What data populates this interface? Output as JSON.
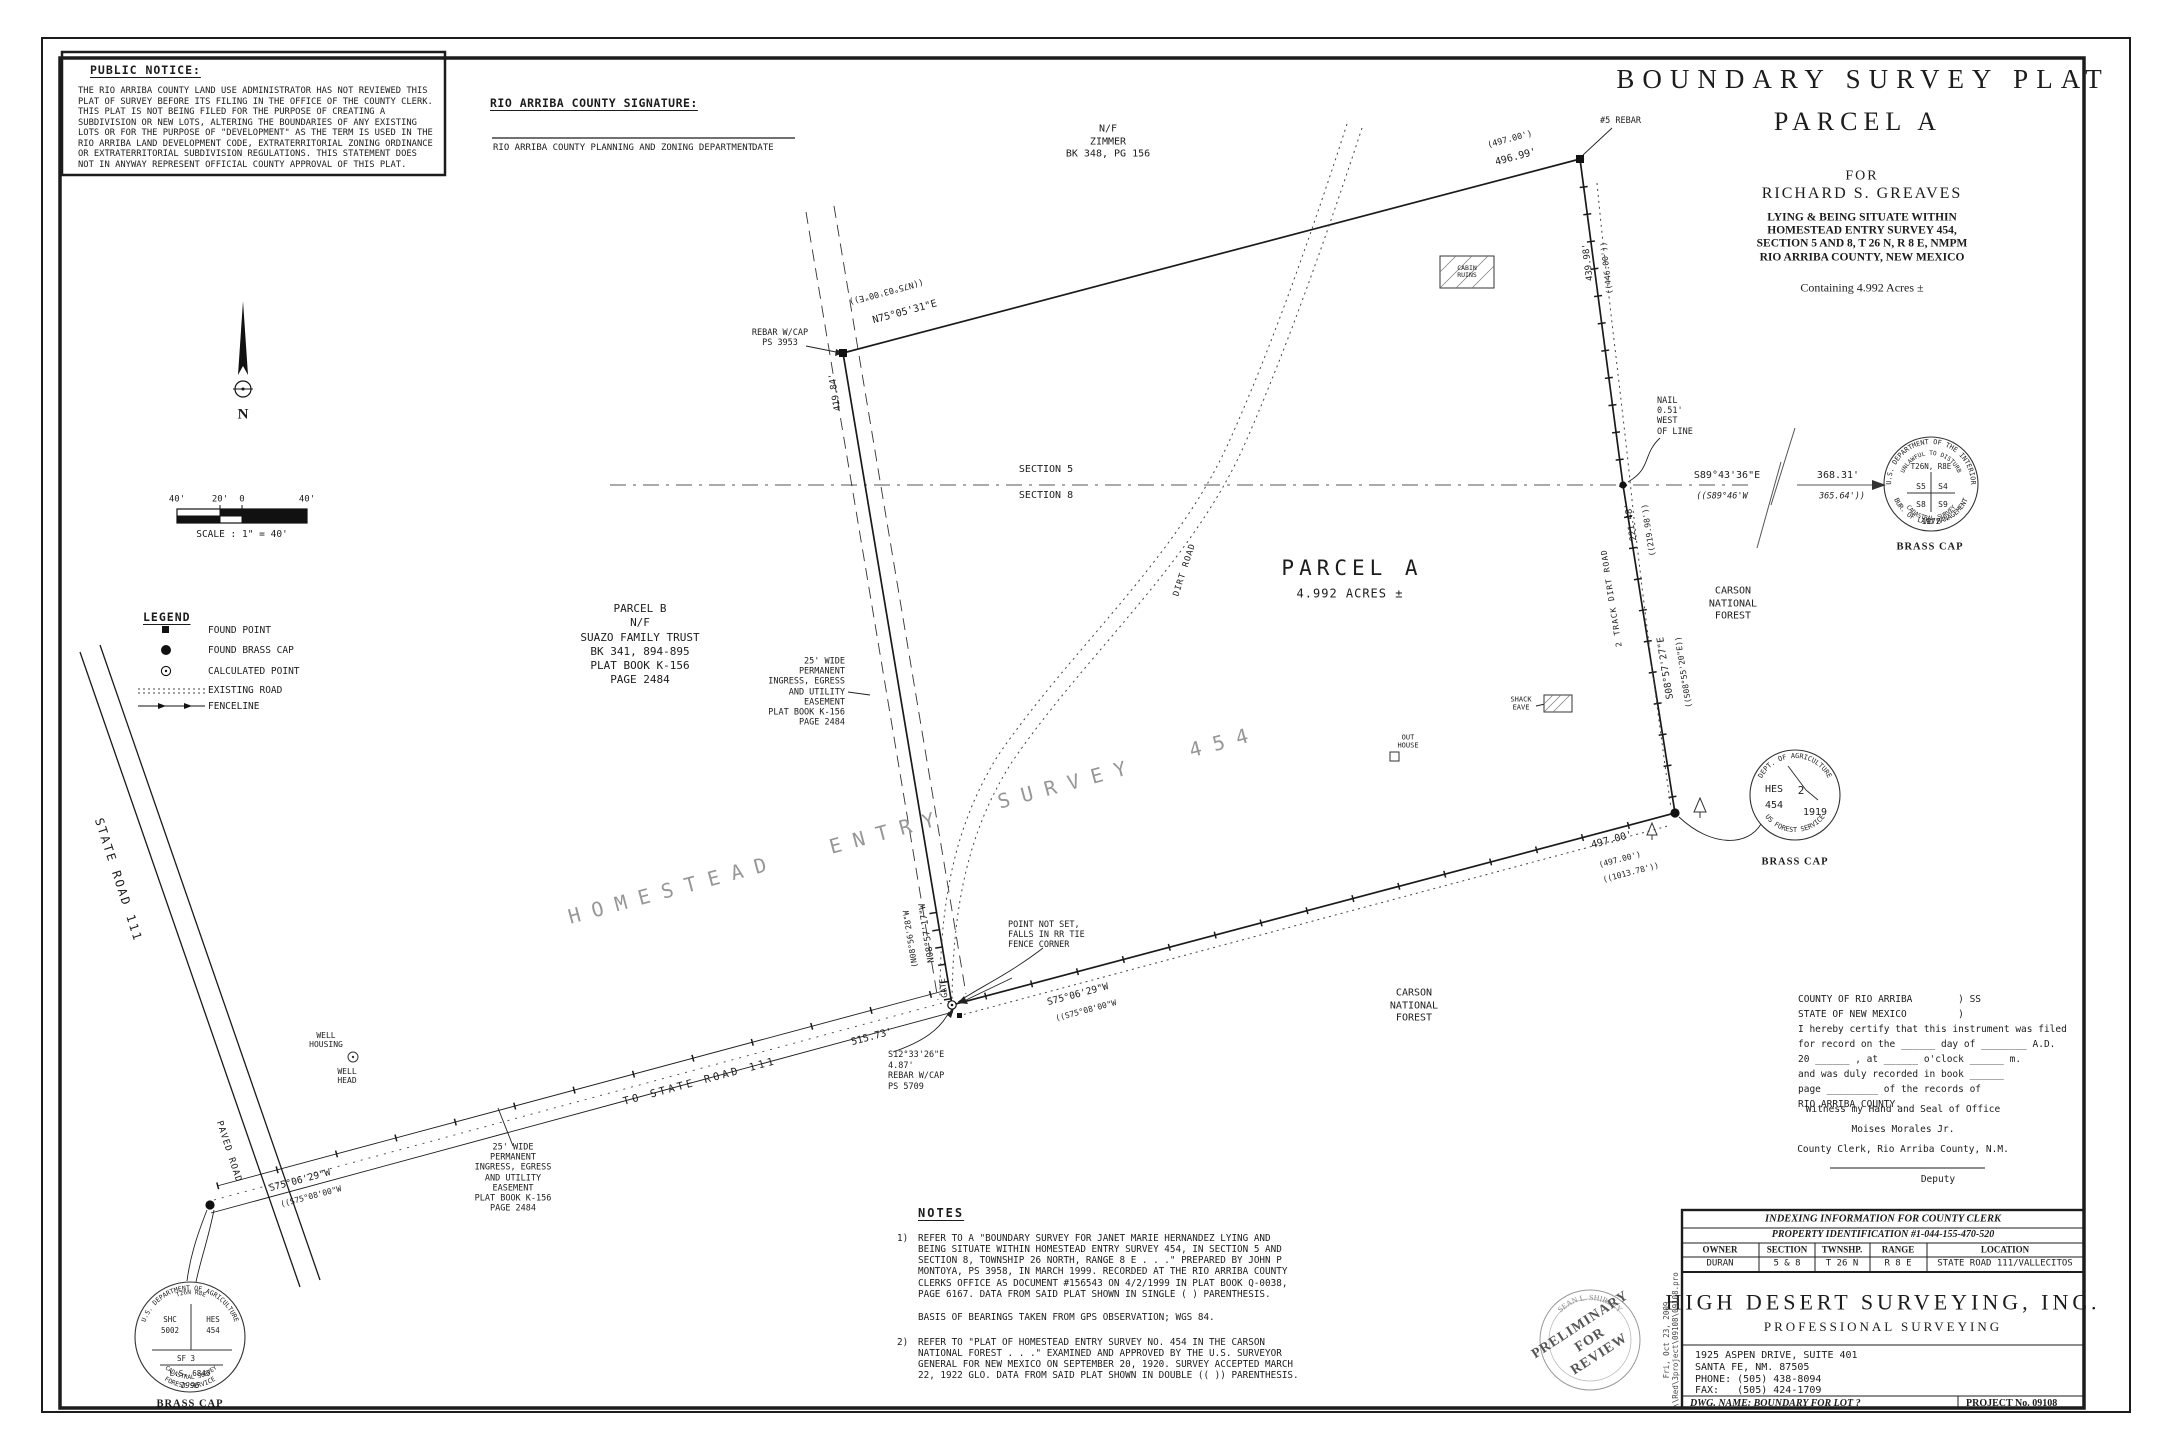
{
  "notice": {
    "heading": "PUBLIC NOTICE:",
    "body": "THE RIO ARRIBA COUNTY LAND USE ADMINISTRATOR HAS NOT REVIEWED THIS PLAT OF SURVEY BEFORE ITS FILING IN THE OFFICE OF THE COUNTY CLERK.  THIS PLAT IS NOT BEING FILED FOR THE PURPOSE OF CREATING A SUBDIVISION OR NEW LOTS, ALTERING THE BOUNDARIES OF ANY EXISTING LOTS OR FOR THE PURPOSE OF \"DEVELOPMENT\" AS THE TERM IS USED IN THE RIO ARRIBA LAND DEVELOPMENT CODE, EXTRATERRITORIAL ZONING ORDINANCE OR EXTRATERRITORIAL SUBDIVISION REGULATIONS.  THIS STATEMENT DOES NOT IN ANYWAY REPRESENT OFFICIAL COUNTY APPROVAL OF THIS PLAT."
  },
  "signature": {
    "heading": "RIO ARRIBA COUNTY SIGNATURE:",
    "dept": "RIO ARRIBA COUNTY PLANNING AND ZONING DEPARTMENT",
    "date": "DATE"
  },
  "title": {
    "main": "BOUNDARY SURVEY PLAT",
    "parcel": "PARCEL A",
    "for_label": "FOR",
    "client": "RICHARD S. GREAVES",
    "situate": "LYING & BEING SITUATE WITHIN\nHOMESTEAD ENTRY SURVEY 454,\nSECTION 5 AND 8, T 26 N, R 8 E, NMPM\nRIO ARRIBA COUNTY, NEW MEXICO",
    "containing": "Containing 4.992 Acres ±"
  },
  "compass": {
    "n": "N"
  },
  "scalebar": {
    "t1": "40'",
    "t2": "20'",
    "t3": "0",
    "t4": "40'",
    "label": "SCALE : 1\" = 40'"
  },
  "legend": {
    "heading": "LEGEND",
    "found_point": "FOUND POINT",
    "found_brass": "FOUND BRASS CAP",
    "calc_point": "CALCULATED POINT",
    "existing_road": "EXISTING ROAD",
    "fenceline": "FENCELINE"
  },
  "parcel_a": {
    "name": "PARCEL A",
    "area": "4.992 ACRES ±"
  },
  "parcel_b": {
    "text": "PARCEL B\nN/F\nSUAZO FAMILY TRUST\nBK 341, 894-895\nPLAT BOOK K-156\nPAGE 2484"
  },
  "zimmer": {
    "text": "N/F\nZIMMER\nBK 348, PG 156"
  },
  "easement_mid": {
    "text": "25' WIDE\nPERMANENT\nINGRESS, EGRESS\nAND UTILITY\nEASEMENT\nPLAT BOOK K-156\nPAGE 2484"
  },
  "easement_sw": {
    "text": "25' WIDE\nPERMANENT\nINGRESS, EGRESS\nAND UTILITY\nEASEMENT\nPLAT BOOK K-156\nPAGE 2484"
  },
  "hes_banner": "HOMESTEAD ENTRY SURVEY 454",
  "sections": {
    "s5": "SECTION 5",
    "s8": "SECTION 8"
  },
  "forest_e": "CARSON\nNATIONAL\nFOREST",
  "forest_s": "CARSON\nNATIONAL\nFOREST",
  "features": {
    "dirt_road": "DIRT ROAD",
    "two_track": "2 TRACK DIRT ROAD",
    "cabin": "CABIN\nRUINS",
    "shack": "SHACK\nEAVE",
    "outhouse": "OUT\nHOUSE",
    "gate": "GATE",
    "well": "WELL\nHOUSING",
    "well_head": "WELL\nHEAD",
    "paved_road": "PAVED ROAD",
    "state_road": "STATE ROAD 111",
    "to_state_road": "TO STATE ROAD 111"
  },
  "monuments": {
    "rebar_nw": "REBAR W/CAP\nPS 3953",
    "rebar_ne": "#5 REBAR",
    "nail": "NAIL\n0.51'\nWEST\nOF LINE",
    "point_not_set": "POINT NOT SET,\nFALLS IN RR TIE\nFENCE CORNER",
    "rebar_s": "S12°33'26\"E\n4.87'\nREBAR W/CAP\nPS 5709"
  },
  "bearings": {
    "top": "N75°05'31\"E",
    "top_paren": "((N75°03'00\"E))",
    "top_len": "496.99'",
    "top_len_paren": "(497.00')",
    "ne_len": "439.98'",
    "ne_len_paren": "((446.00'))",
    "sec": "S89°43'36\"E",
    "sec_paren": "((S89°46'W",
    "sec_len": "368.31'",
    "sec_len_paren": "365.64'))",
    "e_len": "221.48'",
    "e_len_paren": "((219.98'))",
    "e_brg": "S08°57'27\"E",
    "e_brg_paren": "((S08°55'20\"E))",
    "s_len": "497.00'",
    "s_len_p1": "(497.00')",
    "s_len_p2": "((1013.78'))",
    "s_brg": "S75°06'29\"W",
    "s_brg_paren": "((S75°08'00\"W",
    "w_brg": "N08°57'17\"W",
    "w_brg_paren": "(N08°56'28\"W",
    "w_len": "419.84'",
    "sw_brg": "S75°06'29\"W",
    "sw_brg_paren": "((S75°08'00\"W",
    "road_len": "515.73'"
  },
  "seal_blm": {
    "ring_top": "U.S. DEPARTMENT OF THE INTERIOR",
    "arc_top": "UNLAWFUL TO DISTURB",
    "twn": "T26N, R8E",
    "q1": "S5",
    "q2": "S4",
    "q3": "S8",
    "q4": "S9",
    "year": "1972",
    "arc_bottom": "CADASTRAL SURVEY",
    "ring_bottom": "BUR. OF LAND MANAGEMENT",
    "label": "BRASS CAP"
  },
  "seal_hes": {
    "ring_top": "DEPT. OF AGRICULTURE",
    "hes": "HES",
    "num": "454",
    "two": "2",
    "year": "1919",
    "ring_bottom": "US FOREST SERVICE",
    "label": "BRASS CAP"
  },
  "seal_fs": {
    "ring_top": "U.S. DEPARTMENT OF AGRICULTURE",
    "twn": "T26N R8E",
    "q1a": "SHC",
    "q1b": "5002",
    "q2a": "HES",
    "q2b": "454",
    "sf": "SF 3",
    "ls": "L.S. 6843",
    "year": "1996",
    "arc_bottom": "CADASTRAL SURVEY",
    "ring_bottom": "FOREST SERVICE",
    "label": "BRASS CAP"
  },
  "clerk": {
    "text": "COUNTY OF RIO ARRIBA        ) SS\nSTATE OF NEW MEXICO         )\nI hereby certify that this instrument was filed\nfor record on the ______ day of ________ A.D.\n20 ______ , at ______ o'clock ______ m.\nand was duly recorded in book ______\npage _________ of the records of\nRIO ARRIBA COUNTY.",
    "witness": "Witness my Hand and Seal of Office\nMoises Morales Jr.\nCounty Clerk, Rio Arriba County, N.M.",
    "deputy": "Deputy"
  },
  "notes": {
    "heading": "NOTES",
    "n1_num": "1)",
    "n1": "REFER TO A \"BOUNDARY SURVEY FOR JANET MARIE HERNANDEZ LYING AND BEING SITUATE WITHIN HOMESTEAD ENTRY SURVEY 454, IN SECTION 5 AND SECTION 8, TOWNSHIP 26 NORTH, RANGE 8 E . . .\" PREPARED BY JOHN P MONTOYA, PS 3958, IN MARCH 1999.  RECORDED AT THE RIO ARRIBA COUNTY CLERKS OFFICE AS DOCUMENT #156543 ON 4/2/1999 IN PLAT BOOK Q-0038, PAGE 6167. DATA FROM SAID PLAT SHOWN IN SINGLE ( ) PARENTHESIS.",
    "basis": "BASIS OF BEARINGS TAKEN FROM GPS OBSERVATION; WGS 84.",
    "n2_num": "2)",
    "n2": "REFER TO \"PLAT OF HOMESTEAD ENTRY SURVEY NO. 454 IN THE CARSON NATIONAL FOREST . . .\" EXAMINED AND APPROVED BY THE U.S. SURVEYOR GENERAL FOR NEW MEXICO ON SEPTEMBER 20, 1920.  SURVEY ACCEPTED MARCH 22, 1922 GLO. DATA FROM SAID PLAT SHOWN IN DOUBLE (( )) PARENTHESIS."
  },
  "indexing": {
    "title": "INDEXING INFORMATION FOR COUNTY CLERK",
    "property": "PROPERTY IDENTIFICATION #1-044-155-470-520",
    "h_owner": "OWNER",
    "h_section": "SECTION",
    "h_twnshp": "TWNSHP.",
    "h_range": "RANGE",
    "h_location": "LOCATION",
    "v_owner": "DURAN",
    "v_section": "5 & 8",
    "v_twnshp": "T 26 N",
    "v_range": "R 8 E",
    "v_location": "STATE ROAD 111/VALLECITOS"
  },
  "firm": {
    "name": "HIGH DESERT SURVEYING, INC.",
    "tagline": "PROFESSIONAL SURVEYING",
    "address": "1925 ASPEN DRIVE, SUITE 401\nSANTA FE, NM. 87505\nPHONE: (505) 438-8094\nFAX:   (505) 424-1709",
    "dwg": "DWG. NAME: BOUNDARY FOR LOT ?",
    "project": "PROJECT No. 09108",
    "file_info": "Fri, Oct 23, 2009\n\\\\Red\\3project\\09108\\09108.pro"
  },
  "stamp": {
    "name": "SEAN L. SHIRLEY",
    "text": "PRELIMINARY\nFOR\nREVIEW"
  }
}
